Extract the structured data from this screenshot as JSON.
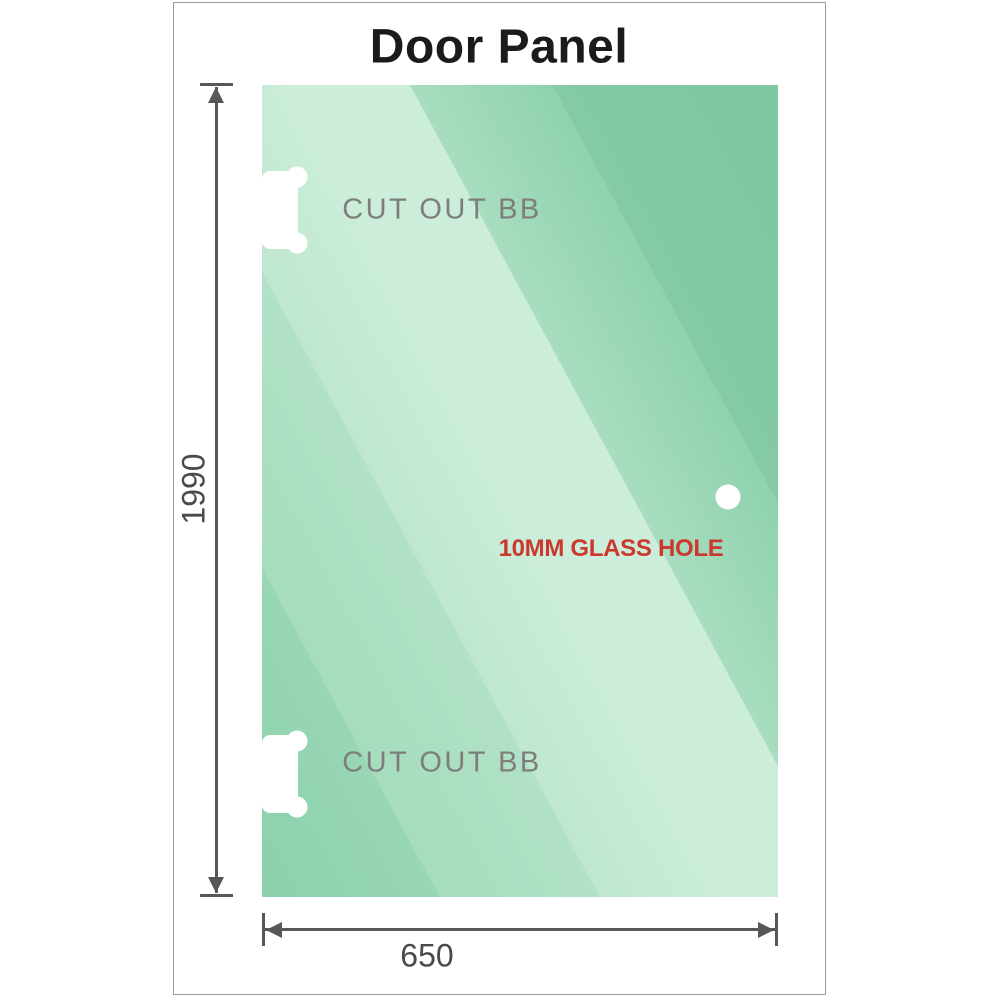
{
  "title": "Door Panel",
  "panel": {
    "cutout_top_label": "CUT OUT BB",
    "cutout_bottom_label": "CUT OUT BB",
    "hole_label": "10MM GLASS HOLE",
    "gradient": [
      "#8bd0ac",
      "#98d6b4",
      "#a6ddbe",
      "#b1e1c6",
      "#bfe7cf",
      "#cbedd9",
      "#cbedd9",
      "#a8ddbf",
      "#8ed2ae",
      "#84cba4",
      "#7fc8a1"
    ]
  },
  "dimensions": {
    "height_value": "1990",
    "width_value": "650"
  },
  "colors": {
    "title_text": "#1b1b1b",
    "cutout_text": "#7d7d7d",
    "hole_text": "#cb392e",
    "dimension_lines": "#575757",
    "dimension_text": "#4a4a4a",
    "frame_border": "#9c9c9c",
    "glass_base": "#9ad7b5",
    "cutout_fill": "#ffffff"
  }
}
